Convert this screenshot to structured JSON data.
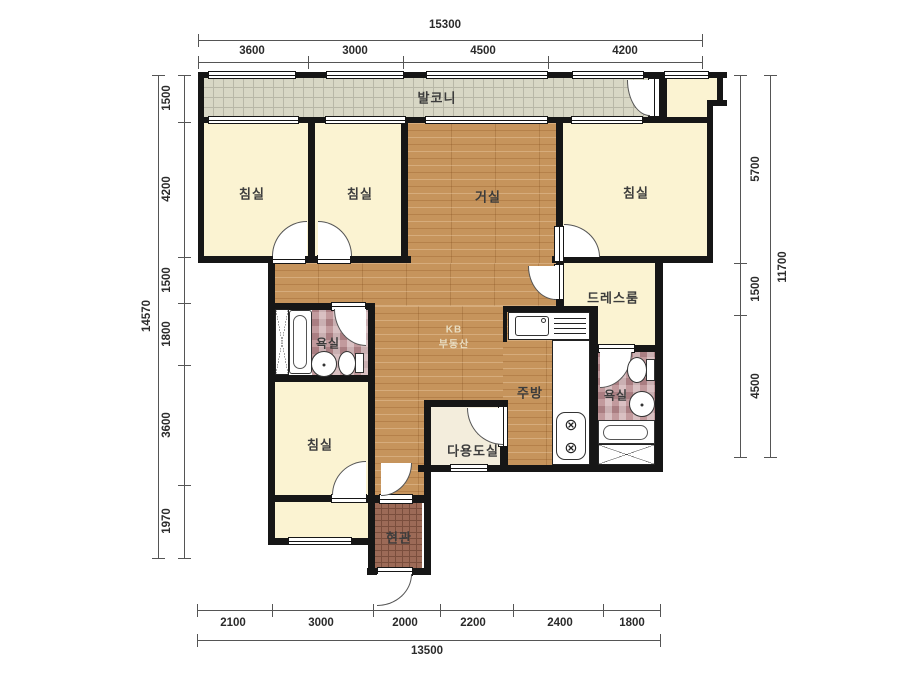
{
  "plan": {
    "type": "apartment-floorplan",
    "watermark": {
      "line1": "KB",
      "line2": "부동산"
    }
  },
  "rooms": {
    "balcony": {
      "label": "발코니"
    },
    "bedroom_top_left": {
      "label": "침실"
    },
    "bedroom_top_mid": {
      "label": "침실"
    },
    "living": {
      "label": "거실"
    },
    "bedroom_top_right": {
      "label": "침실"
    },
    "dressroom": {
      "label": "드레스룸"
    },
    "bath_left": {
      "label": "욕실"
    },
    "bath_right": {
      "label": "욕실"
    },
    "kitchen": {
      "label": "주방"
    },
    "utility": {
      "label": "다용도실"
    },
    "bedroom_bottom": {
      "label": "침실"
    },
    "entry": {
      "label": "현관"
    }
  },
  "dimensions": {
    "top": {
      "total": "15300",
      "segments": [
        "3600",
        "3000",
        "4500",
        "4200"
      ]
    },
    "left": {
      "total": "14570",
      "segments": [
        "1500",
        "4200",
        "1500",
        "1800",
        "3600",
        "1970"
      ]
    },
    "right": {
      "total": "11700",
      "segments": [
        "5700",
        "1500",
        "4500"
      ]
    },
    "bottom": {
      "total": "13500",
      "segments": [
        "2100",
        "3000",
        "2000",
        "2200",
        "2400",
        "1800"
      ]
    }
  },
  "icons": {
    "washer": "⊗"
  },
  "colors": {
    "wall": "#161616",
    "wood_floor": "#c6945c",
    "room_cream": "#fbf3d2",
    "balcony_tile": "#d8d7c5",
    "bath_tile": "#c29a9d",
    "entry_tile": "#9c6a57",
    "utility_floor": "#f3eddc",
    "dimension_text": "#2b2b2b",
    "watermark": "#e8dcc0"
  }
}
